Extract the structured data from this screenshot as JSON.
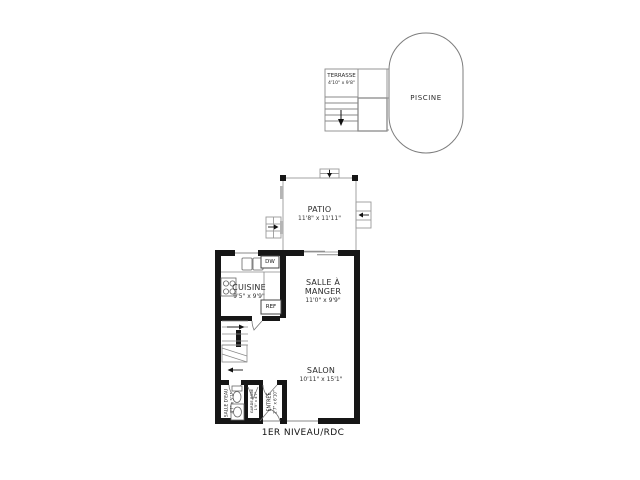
{
  "plan": {
    "caption": "1ER NIVEAU/RDC",
    "pool": {
      "label": "PISCINE"
    },
    "terrasse": {
      "label": "TERRASSE",
      "dims": "4'10\" x 9'8\""
    },
    "patio": {
      "label": "PATIO",
      "dims": "11'8\" x 11'11\""
    },
    "cuisine": {
      "label": "CUISINE",
      "dims": "9'5\" x 9'9\""
    },
    "salle_a_manger": {
      "label": "SALLE À MANGER",
      "dims": "11'0\" x 9'9\""
    },
    "salon": {
      "label": "SALON",
      "dims": "10'11\" x 15'1\""
    },
    "salle_deau": {
      "label": "SALLE D'EAU",
      "dims": "4'7\" x 5'1\""
    },
    "garde_robe": {
      "label": "GARDE-ROBE",
      "dims": "1'9\" x 4'7\""
    },
    "entree": {
      "label": "ENTRÉE",
      "dims": "2'7\" x 6'10\""
    },
    "fixtures": {
      "dishwasher": "DW",
      "refrigerator": "REF"
    },
    "colors": {
      "wall": "#161616",
      "thin": "#8a8a8a",
      "background": "#ffffff",
      "text": "#222222"
    }
  }
}
